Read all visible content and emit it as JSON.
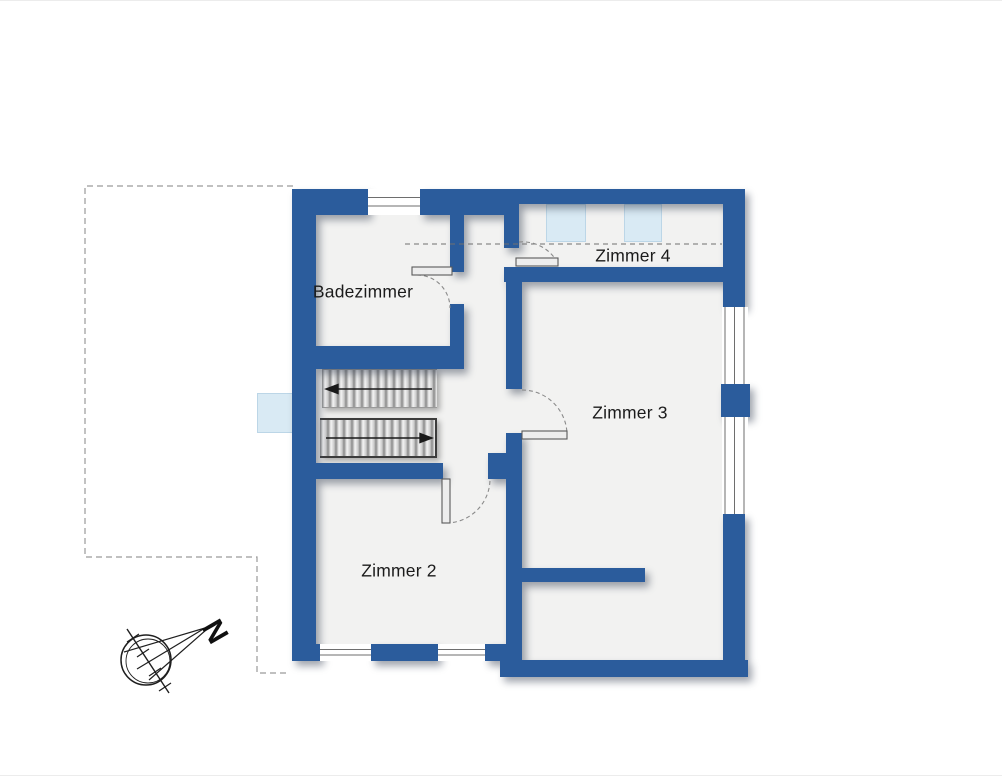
{
  "floorplan": {
    "rooms": [
      {
        "id": "badezimmer",
        "label": "Badezimmer"
      },
      {
        "id": "zimmer-4",
        "label": "Zimmer 4"
      },
      {
        "id": "zimmer-3",
        "label": "Zimmer 3"
      },
      {
        "id": "zimmer-2",
        "label": "Zimmer 2"
      }
    ],
    "compass": {
      "north_label": "N"
    },
    "features": {
      "staircase_flights": 2,
      "skylights": 3,
      "doors": 4
    },
    "colors": {
      "wall": "#2b5c9c",
      "floor": "#f2f2f1",
      "skylight": "#d9eaf4",
      "background": "#ffffff"
    }
  }
}
